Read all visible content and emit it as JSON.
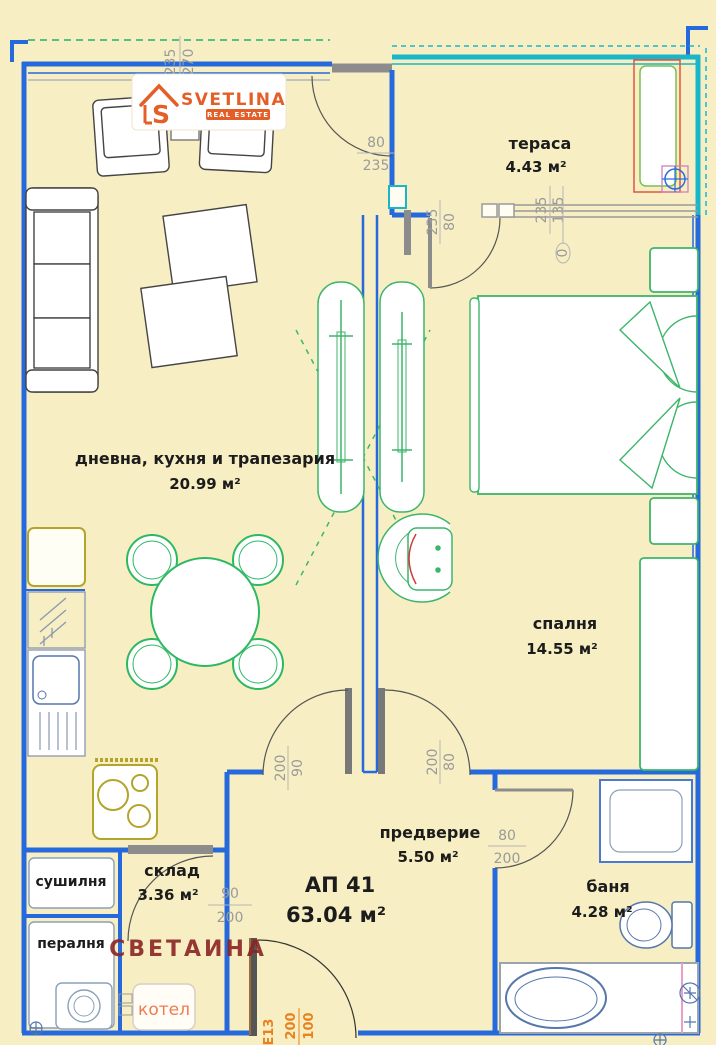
{
  "branding": {
    "logo_text": "SVETLINA",
    "logo_sub": "REAL ESTATE",
    "logo_color": "#e45f28"
  },
  "watermark": "СВЕТАИНА",
  "apartment": {
    "label": "АП 41",
    "area": "63.04 м²"
  },
  "rooms": {
    "terrace": {
      "name": "тераса",
      "area": "4.43 м²"
    },
    "living": {
      "name": "дневна, кухня и трапезария",
      "area": "20.99 м²"
    },
    "bedroom": {
      "name": "спалня",
      "area": "14.55 м²"
    },
    "hallway": {
      "name": "предверие",
      "area": "5.50 м²"
    },
    "storage": {
      "name": "склад",
      "area": "3.36 м²"
    },
    "bathroom": {
      "name": "баня",
      "area": "4.28 м²"
    },
    "drying": {
      "name": "сушилня"
    },
    "laundry": {
      "name": "пералня"
    },
    "boiler": {
      "name": "котел"
    }
  },
  "dimensions": {
    "top_window": {
      "w": "270",
      "h": "235"
    },
    "top_door": {
      "w": "80",
      "h": "235"
    },
    "balcony_door": {
      "w": "80",
      "h": "235"
    },
    "bedroom_window": {
      "w": "135",
      "h": "235",
      "offset": "0"
    },
    "living_door": {
      "w": "90",
      "h": "200"
    },
    "bedroom_door": {
      "w": "80",
      "h": "200"
    },
    "bath_door": {
      "w": "80",
      "h": "200"
    },
    "storage_door": {
      "w": "90",
      "h": "200"
    },
    "entrance_door": {
      "w": "100",
      "h": "200",
      "code": "Е13"
    }
  },
  "colors": {
    "background": "#f7efc3",
    "wall_blue": "#2569dd",
    "teal": "#19b5c8",
    "furniture_green": "#3db56a",
    "olive": "#b3a52b",
    "fixture_blue": "#4a6fae",
    "dimension_gray": "#9a9a9a",
    "orange": "#e8821e",
    "watermark_red": "#8b2424"
  }
}
